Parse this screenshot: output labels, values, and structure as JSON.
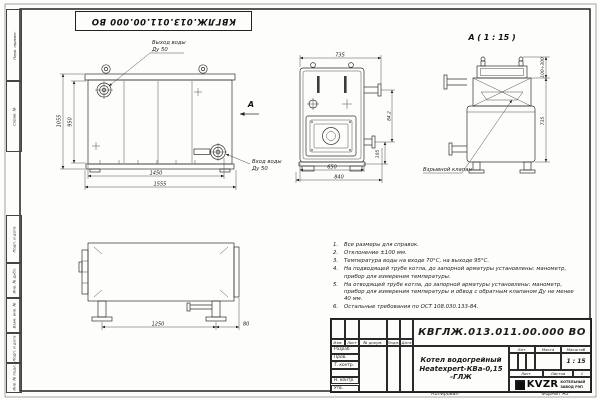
{
  "sheet": {
    "top_doc_number": "КВГЛЖ.013.011.00.000 ВО",
    "stamp_fields": [
      "Перв. примен.",
      "Справ. №",
      "Подп. и дата",
      "Инв. № дубл.",
      "Взам. инв. №",
      "Подп. и дата",
      "Инв. № подл."
    ],
    "copied_label": "Копировал",
    "format_label": "Формат А3"
  },
  "views": {
    "front": {
      "outlet_label_1": "Выход воды",
      "outlet_label_2": "Ду 50",
      "inlet_label_1": "Вход воды",
      "inlet_label_2": "Ду 50",
      "section_arrow": "А",
      "dim_height_outer": "1055",
      "dim_height_inner": "950",
      "dim_width_inner": "1450",
      "dim_width_outer": "1555"
    },
    "side": {
      "dim_top": "735",
      "dim_bottom_inner": "650",
      "dim_bottom_outer": "840",
      "dim_right_upper": "84.2",
      "dim_right_lower": "105"
    },
    "detail": {
      "title": "А ( 1 : 15 )",
      "valve_label": "Взрывной клапан",
      "dim_valve_range": "100÷300",
      "dim_height": "735"
    },
    "bottom": {
      "dim_legs": "1250",
      "dim_offset": "80"
    }
  },
  "notes": [
    {
      "n": "1.",
      "text": "Все размеры для справок."
    },
    {
      "n": "2.",
      "text": "Отклонение ±100 мм."
    },
    {
      "n": "3.",
      "text": "Температура воды на входе 70°С, на выходе 95°С."
    },
    {
      "n": "4.",
      "text": "На подводящей трубе котла, до запорной арматуры установлены: манометр, прибор для измерения температуры."
    },
    {
      "n": "5.",
      "text": "На отводящей трубе котла, до запорной арматуры установлены: манометр, прибор для измерения температуры и обвод с обратным клапаном Ду не менее 40 мм."
    },
    {
      "n": "6.",
      "text": "Остальные требования по ОСТ 108.030.133-84."
    }
  ],
  "title_block": {
    "doc_number": "КВГЛЖ.013.011.00.000 ВО",
    "product_name_1": "Котел водогрейный",
    "product_name_2": "Heatexpert-КВа-0,15 -ГЛЖ",
    "col_izm": "Изм.",
    "col_list": "Лист",
    "col_doc": "№ докум.",
    "col_sign": "Подп.",
    "col_date": "Дата",
    "row_developed": "Разраб.",
    "row_checked": "Пров.",
    "row_tcontrol": "Т. контр.",
    "row_ncontrol": "Н. контр.",
    "row_approved": "Утв.",
    "lit_label": "Лит.",
    "mass_label": "Масса",
    "scale_label": "Масштаб",
    "scale_value": "1 : 15",
    "sheet_label": "Лист",
    "sheets_label": "Листов",
    "sheets_value": "1",
    "company_logo": "KVZR",
    "company_line_1": "КОТЕЛЬНЫЙ",
    "company_line_2": "ЗАВОД РЭП"
  }
}
